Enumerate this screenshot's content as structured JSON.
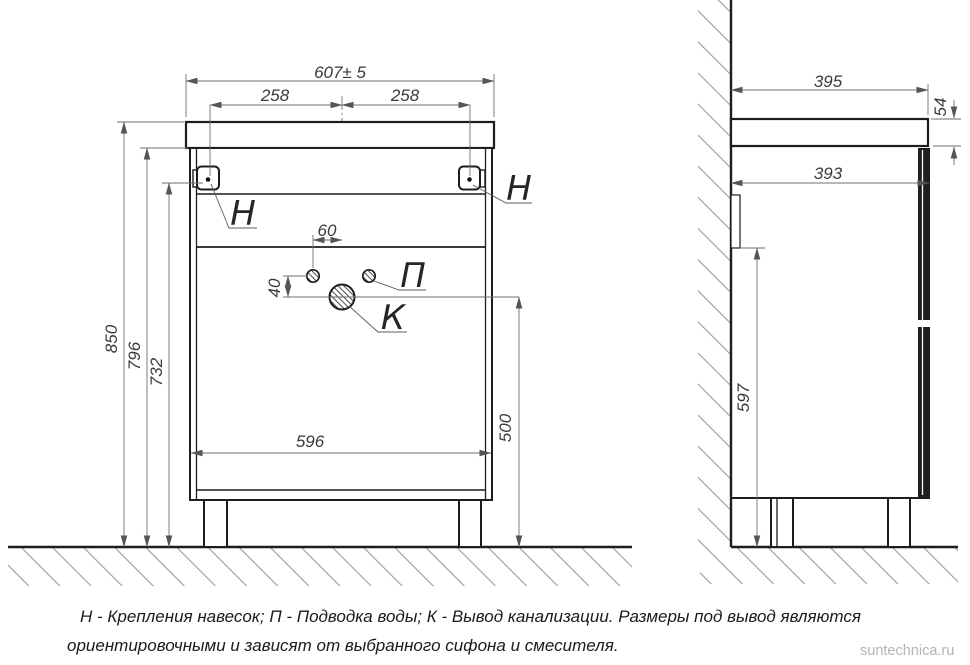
{
  "front_view": {
    "width_total": "607± 5",
    "bracket_offset_left": "258",
    "bracket_offset_right": "258",
    "hole_spacing": "60",
    "hole_drop": "40",
    "drain_height": "500",
    "body_width": "596",
    "height_total": "850",
    "height_body_top": "796",
    "height_brackets": "732",
    "label_bracket_left": "Н",
    "label_bracket_right": "Н",
    "label_water_supply": "П",
    "label_drain": "К"
  },
  "side_view": {
    "depth_total": "395",
    "countertop_thickness": "54",
    "depth_body": "393",
    "height_back_rail": "597"
  },
  "legend": {
    "line1": "Н - Крепления навесок; П - Подводка воды; К - Вывод канализации. Размеры под вывод являются",
    "line2": "ориентировочными и зависят от выбранного сифона и смесителя."
  },
  "watermark": "suntechnica.ru",
  "colors": {
    "outline": "#1d1d1d",
    "dimension": "#6e6e6e",
    "hatch": "#9a9a9a",
    "text": "#3a3a3a",
    "watermark": "#b4b4b4"
  }
}
